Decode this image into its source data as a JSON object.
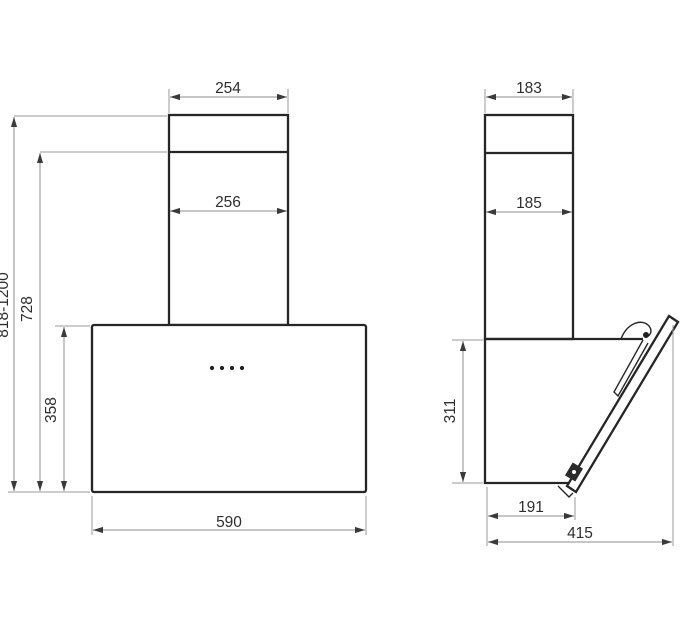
{
  "drawing": {
    "front_view": {
      "dim_chimney_top_width": "254",
      "dim_chimney_lower_width": "256",
      "dim_total_height_range": "818-1200",
      "dim_height_to_chimney_joint": "728",
      "dim_body_height": "358",
      "dim_body_width": "590"
    },
    "side_view": {
      "dim_chimney_top_depth": "183",
      "dim_chimney_lower_depth": "185",
      "dim_body_height": "311",
      "dim_body_bottom_depth": "191",
      "dim_total_depth": "415"
    },
    "colors": {
      "outline": "#262626",
      "dimension_line": "#8c8c8c",
      "text": "#2e2e2e",
      "background": "#ffffff"
    }
  }
}
